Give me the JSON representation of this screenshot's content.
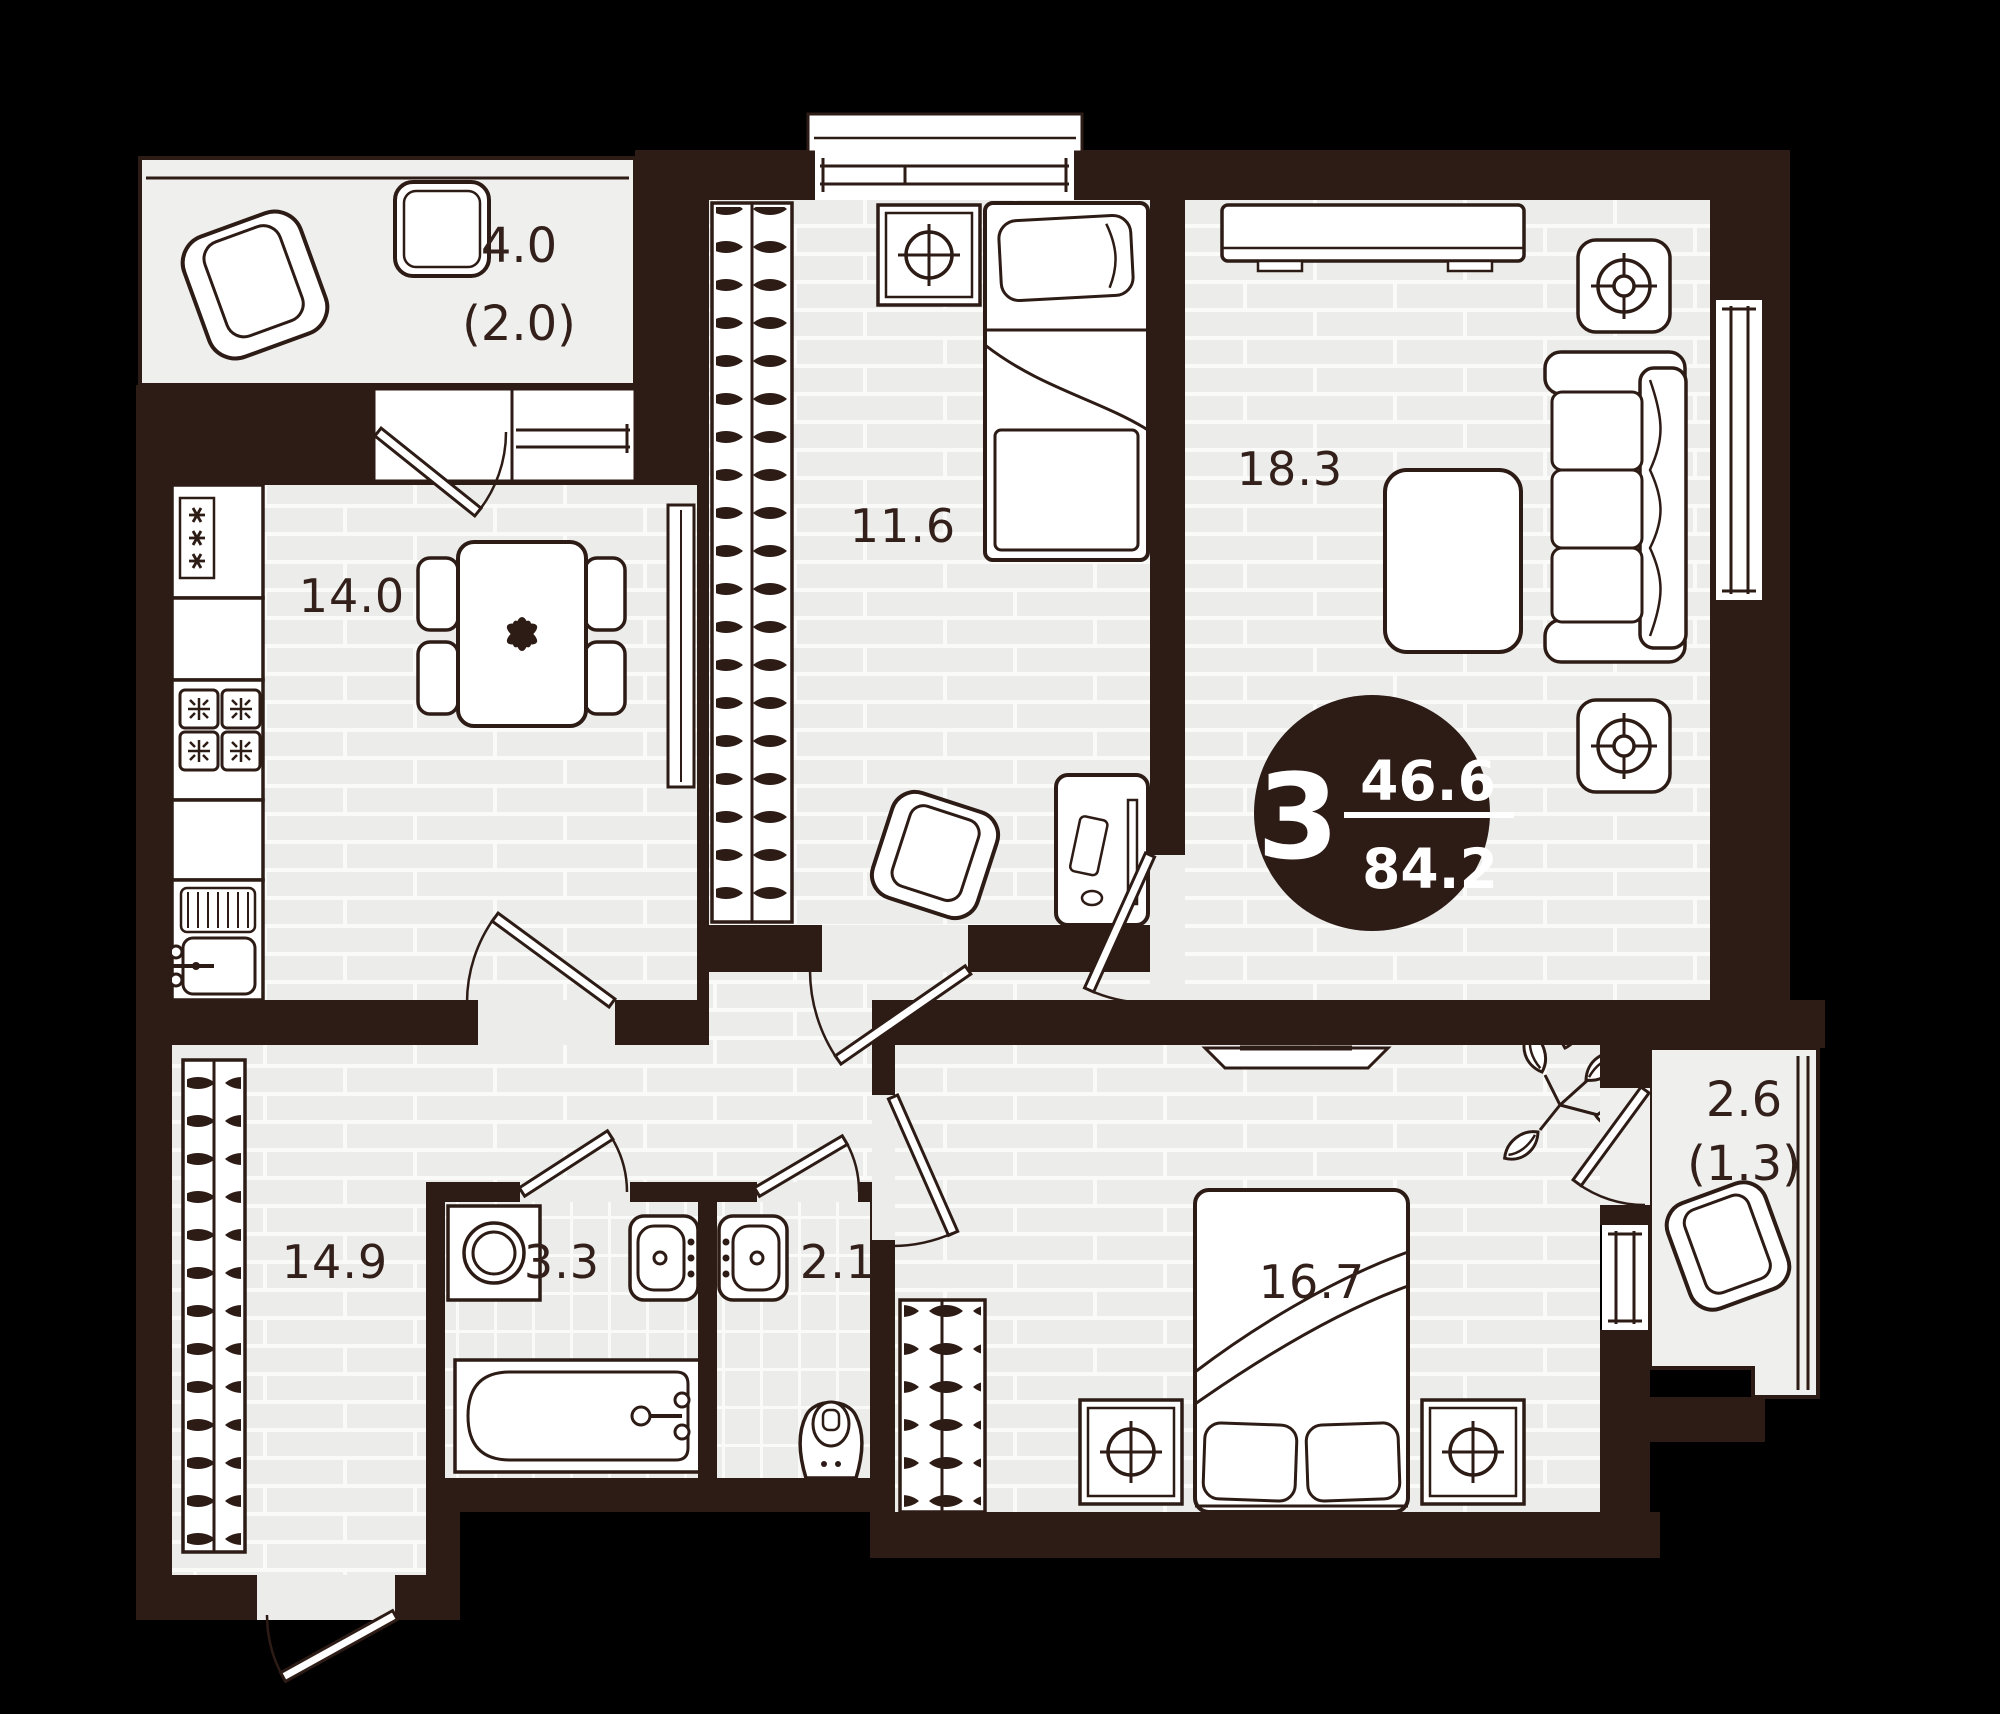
{
  "plan": {
    "type": "apartment-floor-plan",
    "badge": {
      "rooms_count": "3",
      "area_living": "46.6",
      "area_total": "84.2"
    },
    "rooms": {
      "kitchen": "14.0",
      "child_room": "11.6",
      "living_room": "18.3",
      "hallway": "14.9",
      "bathroom": "3.3",
      "wc": "2.1",
      "bedroom": "16.7"
    },
    "balcony_top": {
      "area": "4.0",
      "coeff": "(2.0)"
    },
    "balcony_right": {
      "area": "2.6",
      "coeff": "(1.3)"
    },
    "colors": {
      "background": "#000000",
      "wall": "#2D1B15",
      "floor": "#ECECEA",
      "floor_line": "#FAFAF8",
      "furniture": "#FFFFFF",
      "ink": "#33201A",
      "badge_bg": "#2D1B15",
      "badge_text": "#FFFFFF"
    }
  }
}
